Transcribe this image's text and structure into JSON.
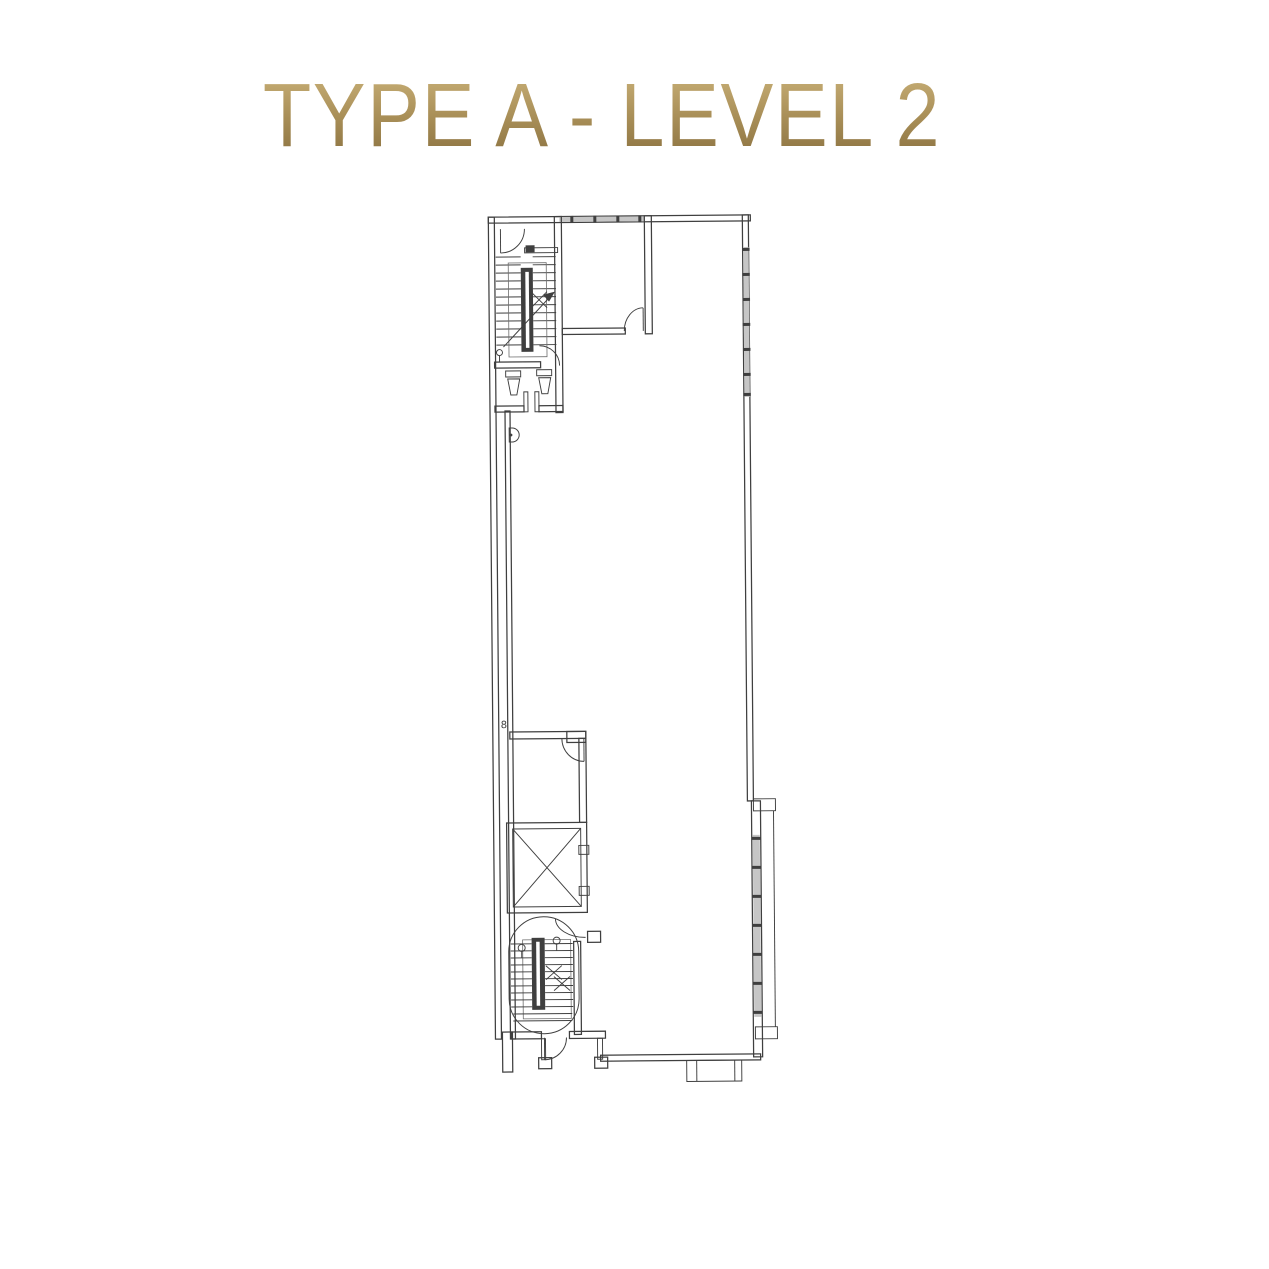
{
  "theme": {
    "background": "#ffffff",
    "line": "#3f3f3f",
    "line-soft": "#6e6e6e",
    "window-fill": "#c6c6c6",
    "gold-top": "#c9b077",
    "gold-mid": "#a88e57",
    "gold-bottom": "#8a7140"
  },
  "title": {
    "text": "TYPE A - LEVEL 2"
  },
  "plan": {
    "annotation_marker": "8"
  }
}
